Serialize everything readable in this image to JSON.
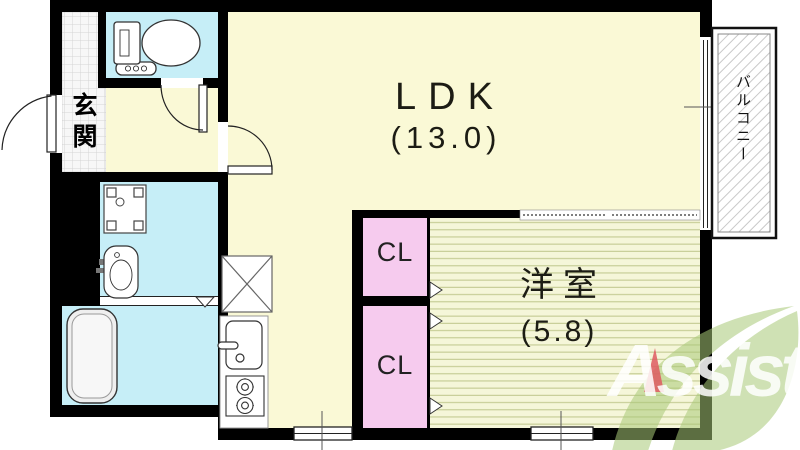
{
  "floor_plan": {
    "rooms": {
      "ldk": {
        "name": "LDK",
        "size": "(13.0)"
      },
      "western_room": {
        "name": "洋室",
        "size": "(5.8)"
      },
      "closet_upper": {
        "label": "CL"
      },
      "closet_lower": {
        "label": "CL"
      },
      "entrance": {
        "label": "玄関"
      },
      "balcony": {
        "label": "バルコニー"
      }
    },
    "fixtures": [
      "toilet",
      "washing-machine-pan",
      "washbasin",
      "bathtub",
      "refrigerator-space",
      "kitchen-sink",
      "gas-stove"
    ],
    "colors": {
      "wall": "#000000",
      "ldk_floor": "#FAF9D6",
      "wet_area": "#C6EEF7",
      "closet": "#F6CBEE",
      "western_room_base": "#F5F6D9",
      "western_room_stripe": "#C3CA92",
      "entrance_tile": "#F7F7F7",
      "balcony_hatch": "#C9C9C9"
    }
  },
  "logo": {
    "text": "Assist",
    "leaf_color": "#A8C877",
    "text_color": "#FFFFFF",
    "accent_color": "#E06064"
  }
}
